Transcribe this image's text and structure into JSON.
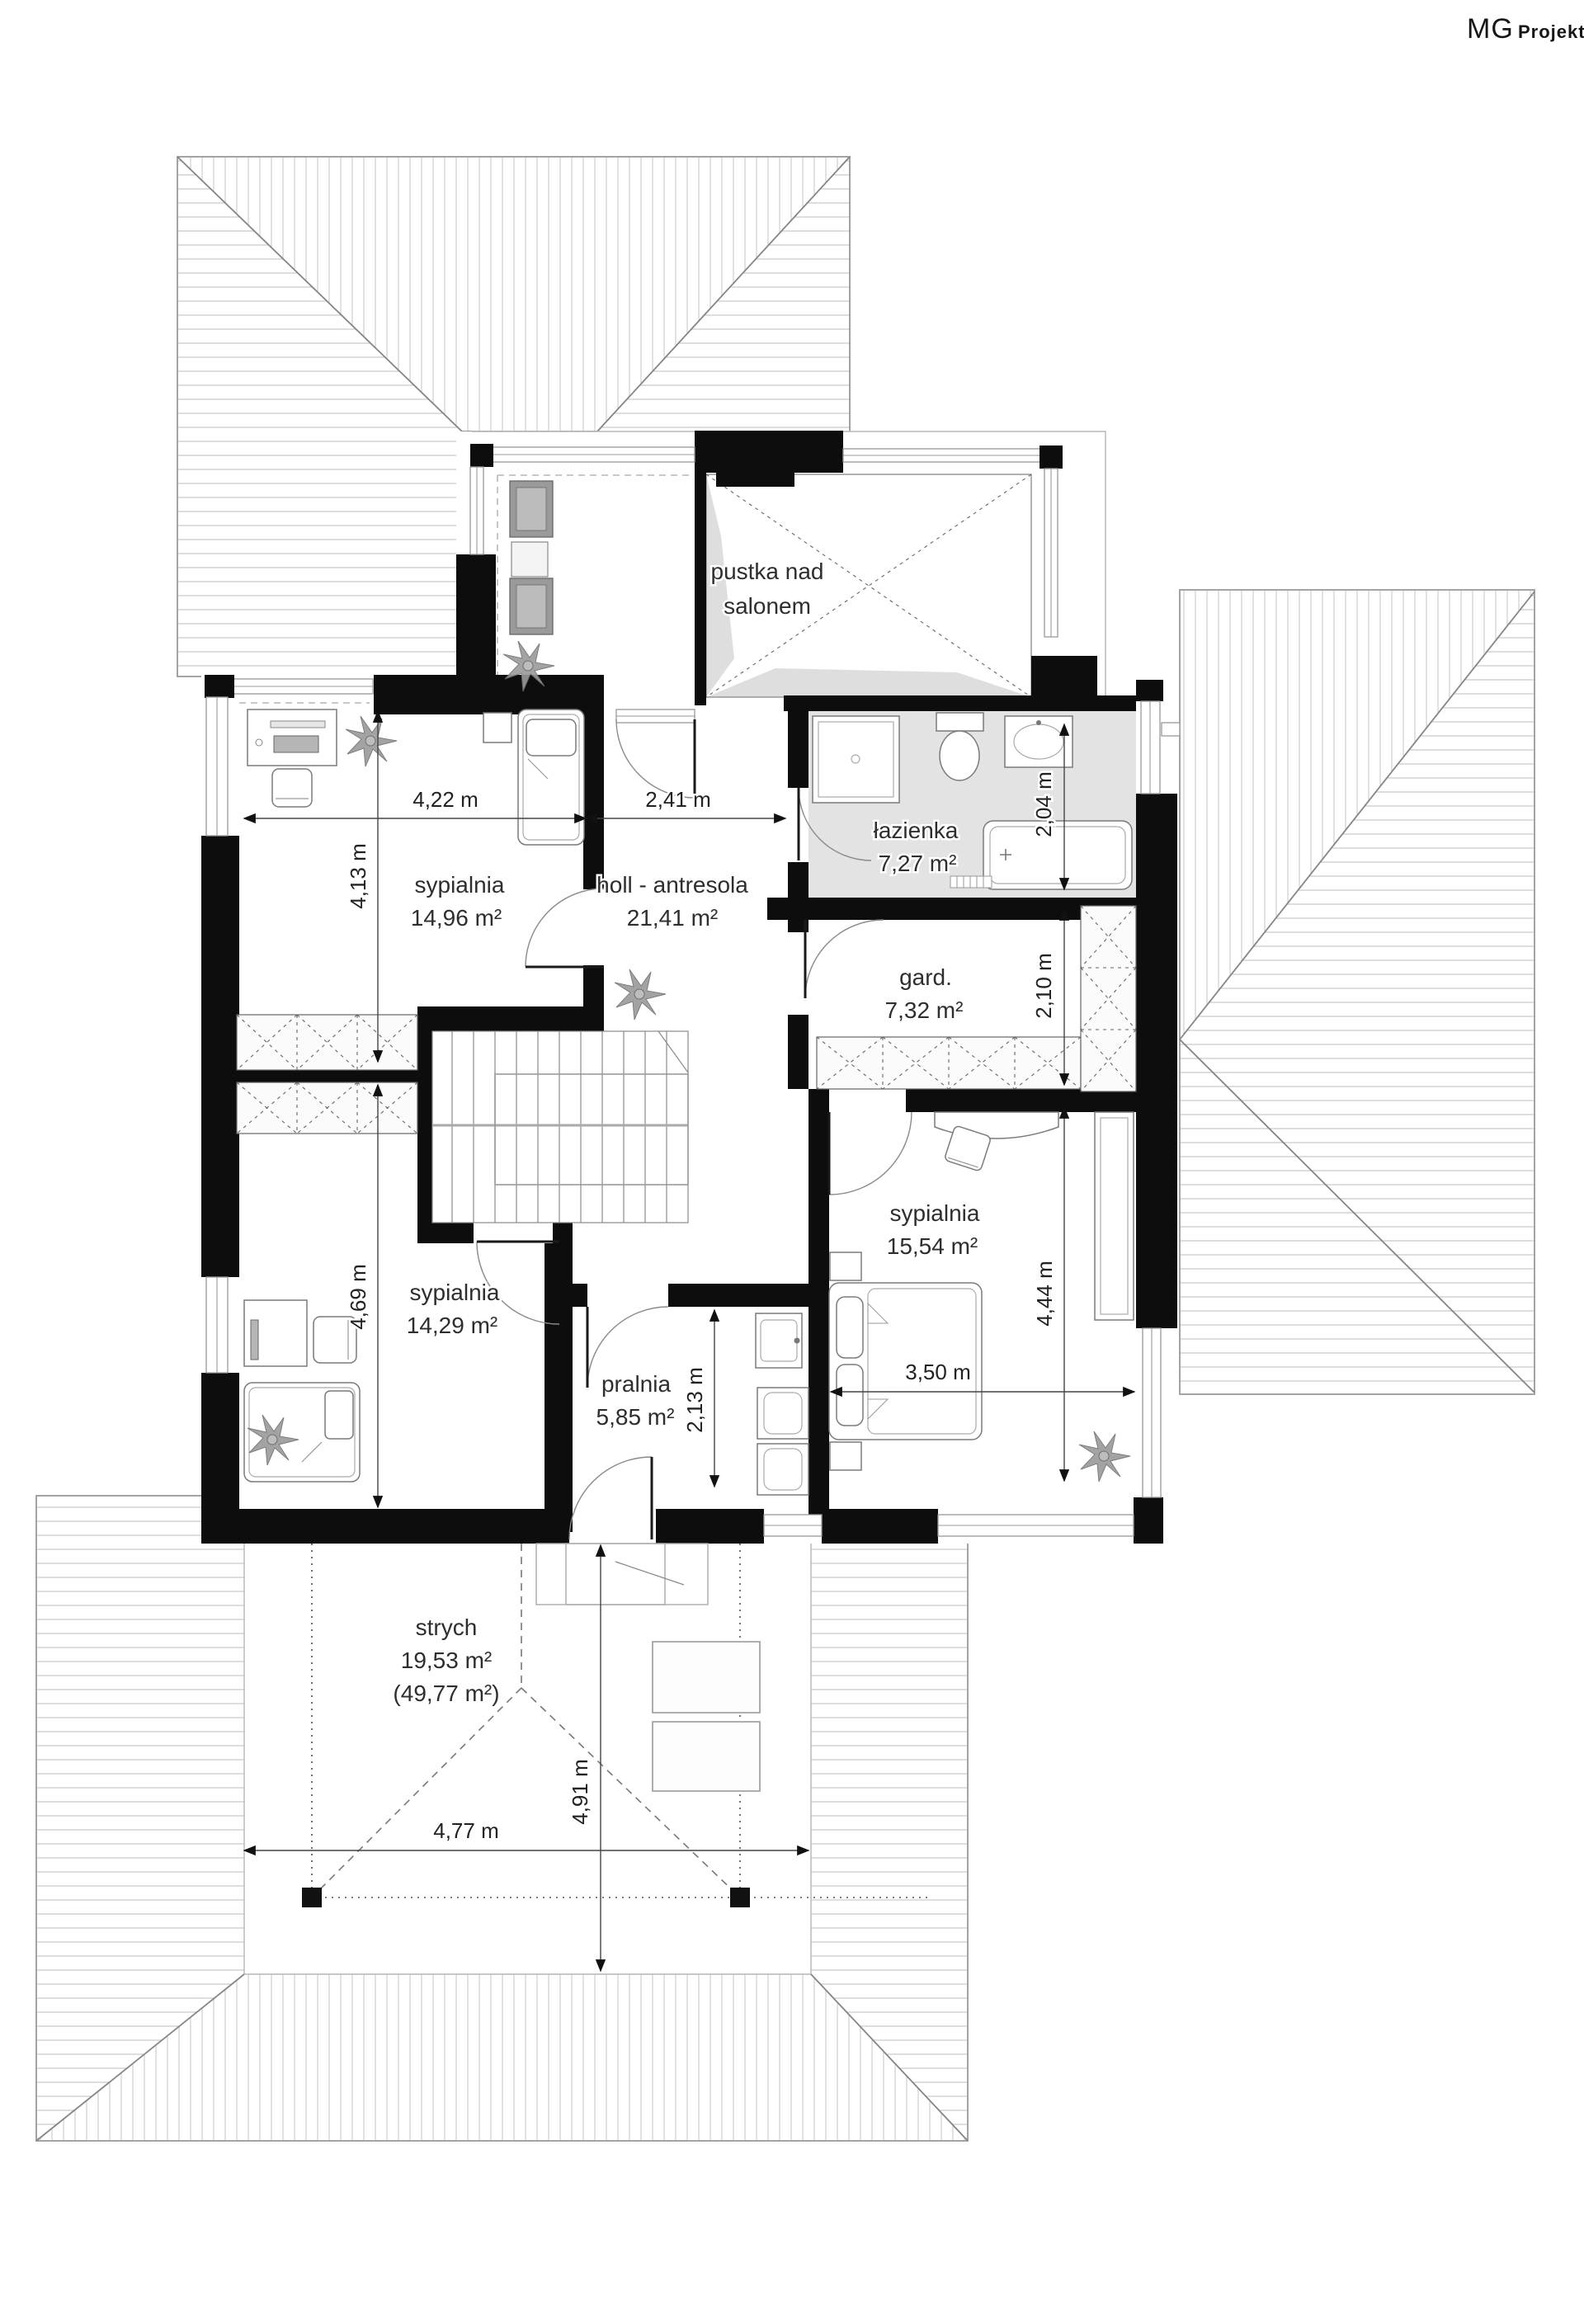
{
  "logo": {
    "mg": "MG",
    "projekt": "Projekt"
  },
  "rooms": {
    "pustka": {
      "line1": "pustka nad",
      "line2": "salonem"
    },
    "lazienka": {
      "name": "łazienka",
      "area": "7,27 m²"
    },
    "sypialnia1": {
      "name": "sypialnia",
      "area": "14,96 m²"
    },
    "holl": {
      "name": "holl - antresola",
      "area": "21,41 m²"
    },
    "gard": {
      "name": "gard.",
      "area": "7,32 m²"
    },
    "sypialnia2": {
      "name": "sypialnia",
      "area": "15,54 m²"
    },
    "sypialnia3": {
      "name": "sypialnia",
      "area": "14,29 m²"
    },
    "pralnia": {
      "name": "pralnia",
      "area": "5,85 m²"
    },
    "strych": {
      "name": "strych",
      "area": "19,53 m²",
      "area_total": "(49,77 m²)"
    }
  },
  "dimensions": {
    "sypialnia1_width": "4,22 m",
    "holl_width": "2,41 m",
    "sypialnia1_height": "4,13 m",
    "sypialnia3_height": "4,69 m",
    "lazienka_height": "2,04 m",
    "gard_height": "2,10 m",
    "sypialnia2_height": "4,44 m",
    "sypialnia2_width": "3,50 m",
    "pralnia_height": "2,13 m",
    "strych_width": "4,77 m",
    "strych_height": "4,91 m"
  },
  "colors": {
    "wall": "#0d0d0d",
    "bath_floor": "#e3e3e3",
    "hatch": "#c9c9c9"
  }
}
